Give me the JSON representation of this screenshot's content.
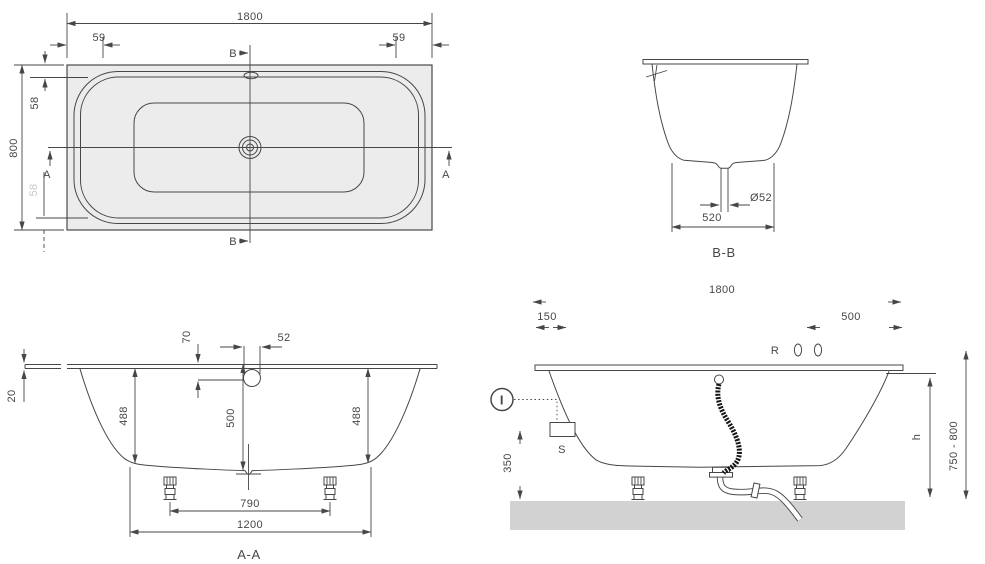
{
  "colors": {
    "line": "#474747",
    "tub_fill": "#ececec",
    "floor": "#d2d2d2",
    "faint": "#c9c9c9",
    "background": "#ffffff",
    "hose": "#151515"
  },
  "views": {
    "plan": {
      "dims": {
        "overall_width": "1800",
        "corner_left": "59",
        "corner_right": "59",
        "overall_depth": "800",
        "rim_inset_top": "58",
        "rim_inset_bottom": "58"
      },
      "markers": {
        "b_top": "B",
        "b_bottom": "B",
        "a_left": "A",
        "a_right": "A"
      }
    },
    "section_bb": {
      "title": "B-B",
      "dims": {
        "drain_diameter": "Ø52",
        "bottom_width": "520"
      }
    },
    "section_aa": {
      "title": "A-A",
      "dims": {
        "rim_thickness": "20",
        "overflow_drop": "70",
        "overflow_width": "52",
        "depth_left": "488",
        "depth_center": "500",
        "depth_right": "488",
        "feet_spacing": "790",
        "bottom_width": "1200"
      }
    },
    "elevation": {
      "dims": {
        "overall_width": "1800",
        "left_offset": "150",
        "right_offset": "500",
        "floor_clearance": "350",
        "height_var": "h",
        "height_range": "750 - 800"
      },
      "labels": {
        "tap": "R",
        "remote": "I",
        "control": "S"
      }
    }
  }
}
